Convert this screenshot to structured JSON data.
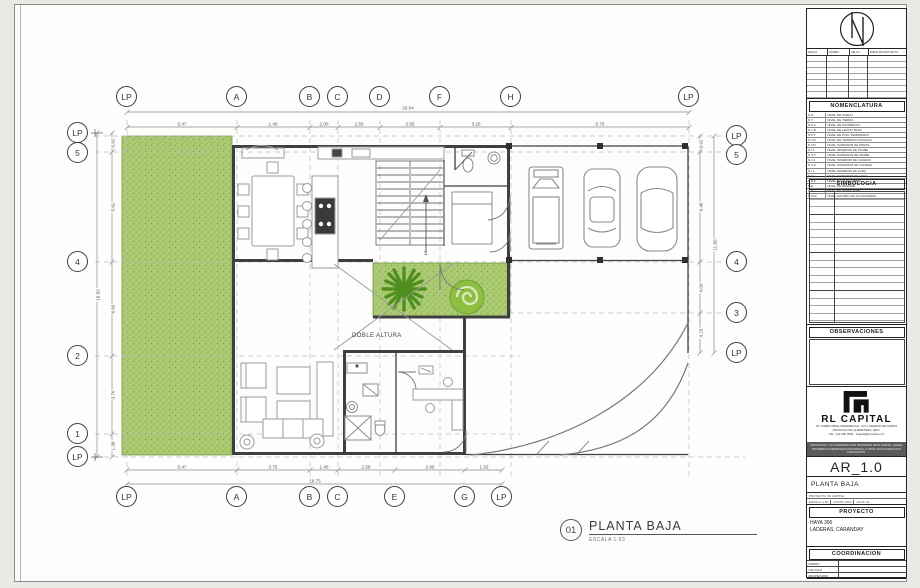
{
  "sheet": {
    "plan_number": "01",
    "plan_title": "PLANTA BAJA",
    "plan_scale": "ESCALA 1:93"
  },
  "plan": {
    "double_height_label": "DOBLE ALTURA",
    "stairs_label": "S"
  },
  "grid": {
    "top": [
      "LP",
      "A",
      "B",
      "C",
      "D",
      "F",
      "H",
      "LP"
    ],
    "bottom": [
      "LP",
      "A",
      "B",
      "C",
      "E",
      "G",
      "LP"
    ],
    "left": [
      "LP",
      "5",
      "4",
      "2",
      "1",
      "LP"
    ],
    "right": [
      "LP",
      "5",
      "4",
      "3",
      "LP"
    ]
  },
  "dims": {
    "top_total": "20.04",
    "top": [
      "5.47",
      "1.40",
      "2.00",
      "2.50",
      "2.55",
      "3.20",
      "5.75"
    ],
    "bottom_total": "19.75",
    "bottom": [
      "5.47",
      "3.75",
      "1.40",
      "2.58",
      "2.95",
      "1.93"
    ],
    "left_total": "18.50",
    "left": [
      "0.92",
      "5.62",
      "6.60",
      "3.70",
      "1.38"
    ],
    "right_total": "11.80",
    "right": [
      "0.92",
      "9.46",
      "4.00",
      "4.23"
    ]
  },
  "titleblock": {
    "rev_headers": [
      "FECHA",
      "CAMBIO",
      "SELLO",
      "FIRMA DE PROYECTO"
    ],
    "nomenclatura_title": "NOMENCLATURA",
    "nomenclatura": [
      {
        "code": "N.N.",
        "desc": "NIVEL DE SUELO"
      },
      {
        "code": "N.T.",
        "desc": "NIVEL DE TIERRA"
      },
      {
        "code": "N.P.A.",
        "desc": "NIVEL DE PAVIMENTO"
      },
      {
        "code": "N.L.B.",
        "desc": "NIVEL DE LECHO BAJO"
      },
      {
        "code": "N.P.T.",
        "desc": "NIVEL DE PISO TERMINADO"
      },
      {
        "code": "N.T.N.",
        "desc": "NIVEL DE TERRENO NATURAL"
      },
      {
        "code": "N.T.P.",
        "desc": "NIVEL SUPERIOR DE PRETIL"
      },
      {
        "code": "N.I.T.",
        "desc": "NIVEL INFERIOR DE TRABE"
      },
      {
        "code": "N.S.T.",
        "desc": "NIVEL SUPERIOR DE TRABE"
      },
      {
        "code": "N.I.C.",
        "desc": "NIVEL INFERIOR DE CADENA"
      },
      {
        "code": "N.S.C.",
        "desc": "NIVEL SUPERIOR DE CADENA"
      },
      {
        "code": "N.I.L.",
        "desc": "NIVEL INFERIOR DE LOSA"
      },
      {
        "code": "N.S.L.",
        "desc": "NIVEL SUPERIOR DE LOSA"
      },
      {
        "code": "N.B.F.",
        "desc": "NIVEL BAJO DE FIRME"
      },
      {
        "code": "N.E.",
        "desc": "NIVEL DE ENRASE"
      },
      {
        "code": "N.D.",
        "desc": "NIVEL DE DESPLANTE"
      },
      {
        "code": "N.M.P.",
        "desc": "NIVEL MAXIMO DE PLATAFORMA"
      }
    ],
    "simbologia_title": "SIMBOLOGIA",
    "observaciones_title": "OBSERVACIONES",
    "brand_name": "RL CAPITAL",
    "brand_lines": [
      "AV. CAMPO REAL RESIDENCIAL, INT. LADERAS DE CAMPO",
      "SANTIAGO DE QUERETARO, QRO.",
      "TEL. 442 000 0000 - rlcapital@contacto.mx"
    ],
    "disclaimer": "ESTE PLANO Y SU CONTENIDO SON PROPIEDAD DE RL CAPITAL. QUEDA PROHIBIDA SU REPRODUCCION PARCIAL O TOTAL SIN AUTORIZACION POR ESCRITO.",
    "sheet_code": "AR_1.0",
    "sheet_title": "PLANTA BAJA",
    "meta_row1": "PROYECTO:  RL CAPITAL",
    "meta_escala": "ESCALA: 1:93",
    "meta_cotas": "COTAS: MTS",
    "meta_hoja": "HOJA: 01",
    "proyecto_title": "PROYECTO",
    "proyecto_line1": "HAYA 396",
    "proyecto_line2": "LADERAS, CARANDAY",
    "coordinacion_title": "COORDINACION",
    "coordinacion_rows": [
      "DISEÑO",
      "CALCULO",
      "PROPIETARIO"
    ]
  }
}
